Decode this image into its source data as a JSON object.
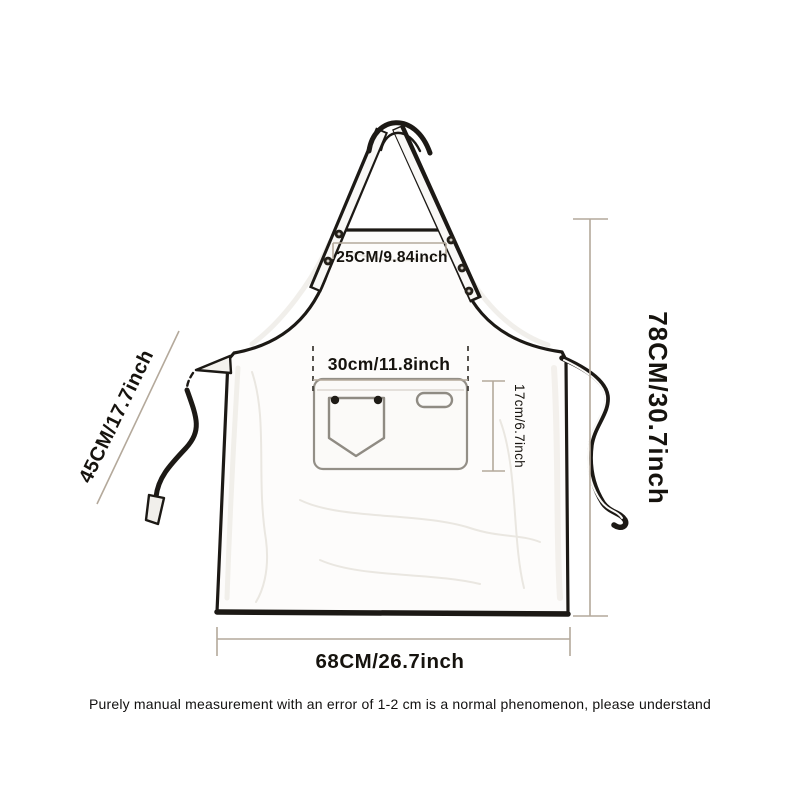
{
  "diagram": {
    "type": "apron-size-chart",
    "labels": {
      "neck_strap_width": "25CM/9.84inch",
      "pocket_width": "30cm/11.8inch",
      "pocket_depth": "17cm/6.7inch",
      "side_tie_length": "45CM/17.7inch",
      "body_height": "78CM/30.7inch",
      "body_width": "68CM/26.7inch"
    },
    "note": "Purely manual measurement with an error of 1-2 cm is a normal phenomenon, please understand",
    "colors": {
      "outline": "#1c1915",
      "dimension_line": "#b4a99b",
      "dashed_guide": "#45413c",
      "text": "#16130e",
      "background": "#ffffff"
    }
  }
}
